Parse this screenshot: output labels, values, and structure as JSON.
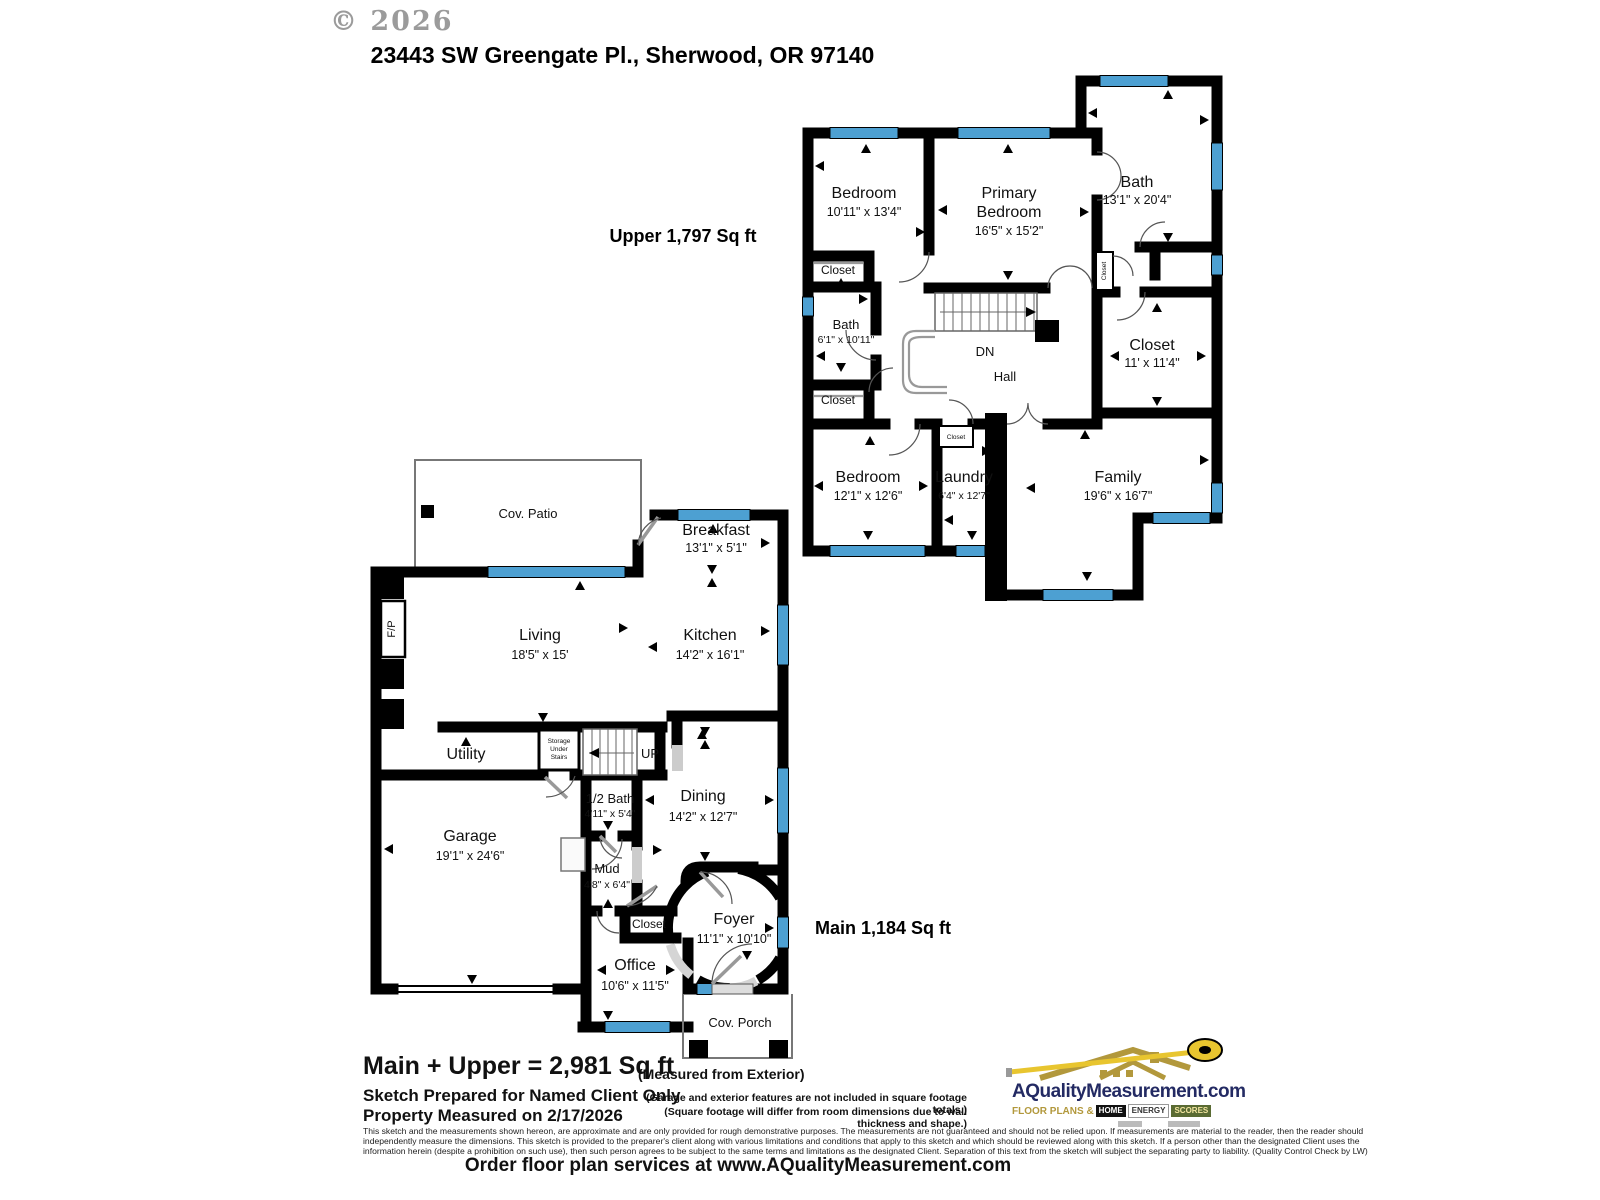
{
  "header": {
    "copyright": "© 2026",
    "address": "23443 SW Greengate Pl., Sherwood, OR 97140"
  },
  "colors": {
    "window_blue": "#4da0d2",
    "wall_black": "#000000",
    "logo_navy": "#232a63",
    "logo_gold": "#b2983c",
    "tape_yellow": "#e8c52f"
  },
  "upper": {
    "area_label": "Upper  1,797 Sq ft",
    "rooms": {
      "bedroom1": {
        "name": "Bedroom",
        "dims": "10'11\" x 13'4\""
      },
      "primary": {
        "name_line1": "Primary",
        "name_line2": "Bedroom",
        "dims": "16'5\" x 15'2\""
      },
      "bath_big": {
        "name": "Bath",
        "dims": "13'1\" x 20'4\""
      },
      "bath_small": {
        "name": "Bath",
        "dims": "6'1\" x 10'11\""
      },
      "closet1": {
        "name": "Closet"
      },
      "closet2": {
        "name": "Closet"
      },
      "closet_tiny": {
        "name": "Closet"
      },
      "laundry_closet": {
        "name": "Closet"
      },
      "closet_room": {
        "name": "Closet",
        "dims": "11' x 11'4\""
      },
      "bedroom2": {
        "name": "Bedroom",
        "dims": "12'1\" x 12'6\""
      },
      "laundry": {
        "name": "Laundry",
        "dims": "6'4\" x 12'7\""
      },
      "family": {
        "name": "Family",
        "dims": "19'6\" x 16'7\""
      },
      "hall": {
        "name": "Hall"
      },
      "stairs_down": {
        "name": "DN"
      }
    }
  },
  "main": {
    "area_label": "Main  1,184 Sq ft",
    "rooms": {
      "patio": {
        "name": "Cov. Patio"
      },
      "breakfast": {
        "name": "Breakfast",
        "dims": "13'1\" x 5'1\""
      },
      "living": {
        "name": "Living",
        "dims": "18'5\" x 15'"
      },
      "kitchen": {
        "name": "Kitchen",
        "dims": "14'2\" x 16'1\""
      },
      "fireplace": {
        "name": "F/P"
      },
      "utility": {
        "name": "Utility"
      },
      "storage": {
        "line1": "Storage",
        "line2": "Under",
        "line3": "Stairs"
      },
      "stairs_up": {
        "name": "UP"
      },
      "half_bath": {
        "name": "1/2 Bath",
        "dims": "4'11\" x 5'4\""
      },
      "dining": {
        "name": "Dining",
        "dims": "14'2\" x 12'7\""
      },
      "garage": {
        "name": "Garage",
        "dims": "19'1\" x 24'6\""
      },
      "mud": {
        "name": "Mud",
        "dims": "4'8\" x 6'4\""
      },
      "closet": {
        "name": "Closet"
      },
      "foyer": {
        "name": "Foyer",
        "dims": "11'1\" x 10'10\""
      },
      "office": {
        "name": "Office",
        "dims": "10'6\" x 11'5\""
      },
      "porch": {
        "name": "Cov. Porch"
      }
    }
  },
  "footer": {
    "total_bold": "Main + Upper = 2,981 Sq ft",
    "measured_from": "(Measured from Exterior)",
    "sketch_line": "Sketch Prepared for Named Client Only",
    "property_line": "Property Measured on 2/17/2026",
    "note1": "(Garage and exterior features are not included in square footage totals.)",
    "note2": "(Square footage will differ from room dimensions due to wall thickness and shape.)",
    "disclaimer1": "This sketch and the measurements shown hereon, are approximate and are only provided for rough demonstrative purposes.  The measurements are not guaranteed and should not be relied upon.  If measurements are material to the reader, then the reader should",
    "disclaimer2": "independently measure the dimensions.  This sketch is provided to the preparer's client along with various limitations and conditions that apply to this sketch and which should be reviewed along with this sketch.  If a person other than the designated Client uses the",
    "disclaimer3": "information herein (despite a prohibition on such use), then such person agrees to be subject to the same terms and limitations as the designated Client.  Separation of this text from the sketch will subject the separating party to liability.  (Quality Control Check by LW)",
    "order_line": "Order floor plan services at www.AQualityMeasurement.com"
  },
  "logo": {
    "name": "AQualityMeasurement.com",
    "tagline": "FLOOR PLANS &",
    "badge_home": "HOME",
    "badge_energy": "ENERGY",
    "badge_scores": "SCORES"
  }
}
